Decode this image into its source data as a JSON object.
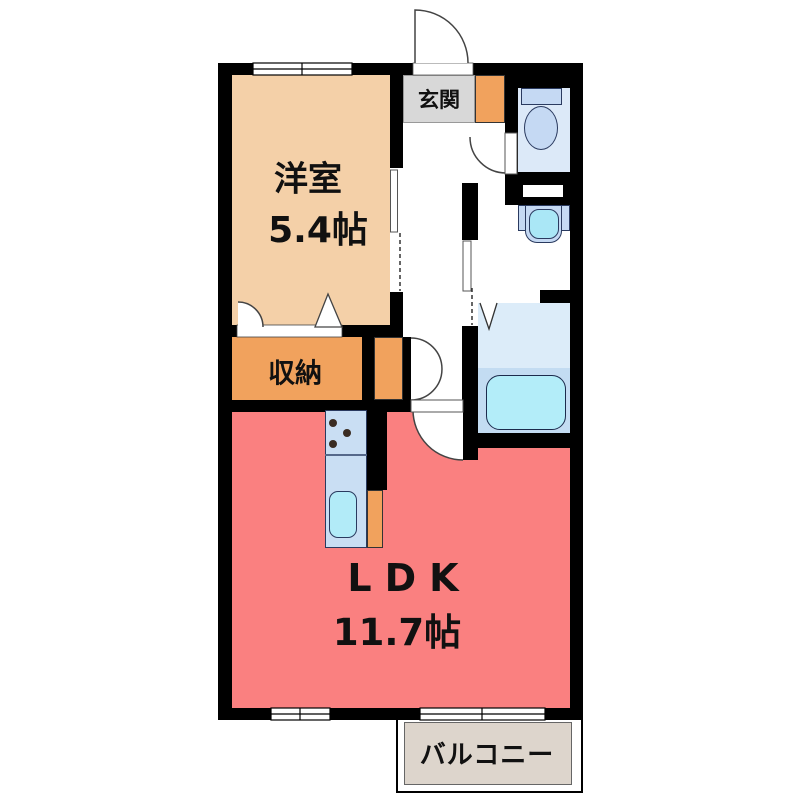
{
  "plan": {
    "rooms": {
      "western_room": {
        "label": "洋室",
        "area": "5.4帖"
      },
      "storage": {
        "label": "収納"
      },
      "entrance": {
        "label": "玄関"
      },
      "ldk": {
        "label": "LDK",
        "area": "11.7帖"
      },
      "balcony": {
        "label": "バルコニー"
      }
    },
    "colors": {
      "wall": "#000000",
      "western_room": "#f4d0a8",
      "storage": "#f1a25d",
      "accent_orange": "#f1a25d",
      "entrance": "#d8d8d8",
      "ldk": "#fa8080",
      "toilet_floor": "#dce9f8",
      "fixture_blue": "#c5d9f3",
      "sink_cyan": "#aae7f6",
      "bath_floor_upper": "#dcecf9",
      "bath_floor_lower": "#c3dcf2",
      "bathtub": "#b3edf9",
      "kitchen_counter": "#c9def3",
      "kitchen_sink": "#b2ebf8",
      "balcony_floor": "#ddd5cc"
    }
  }
}
